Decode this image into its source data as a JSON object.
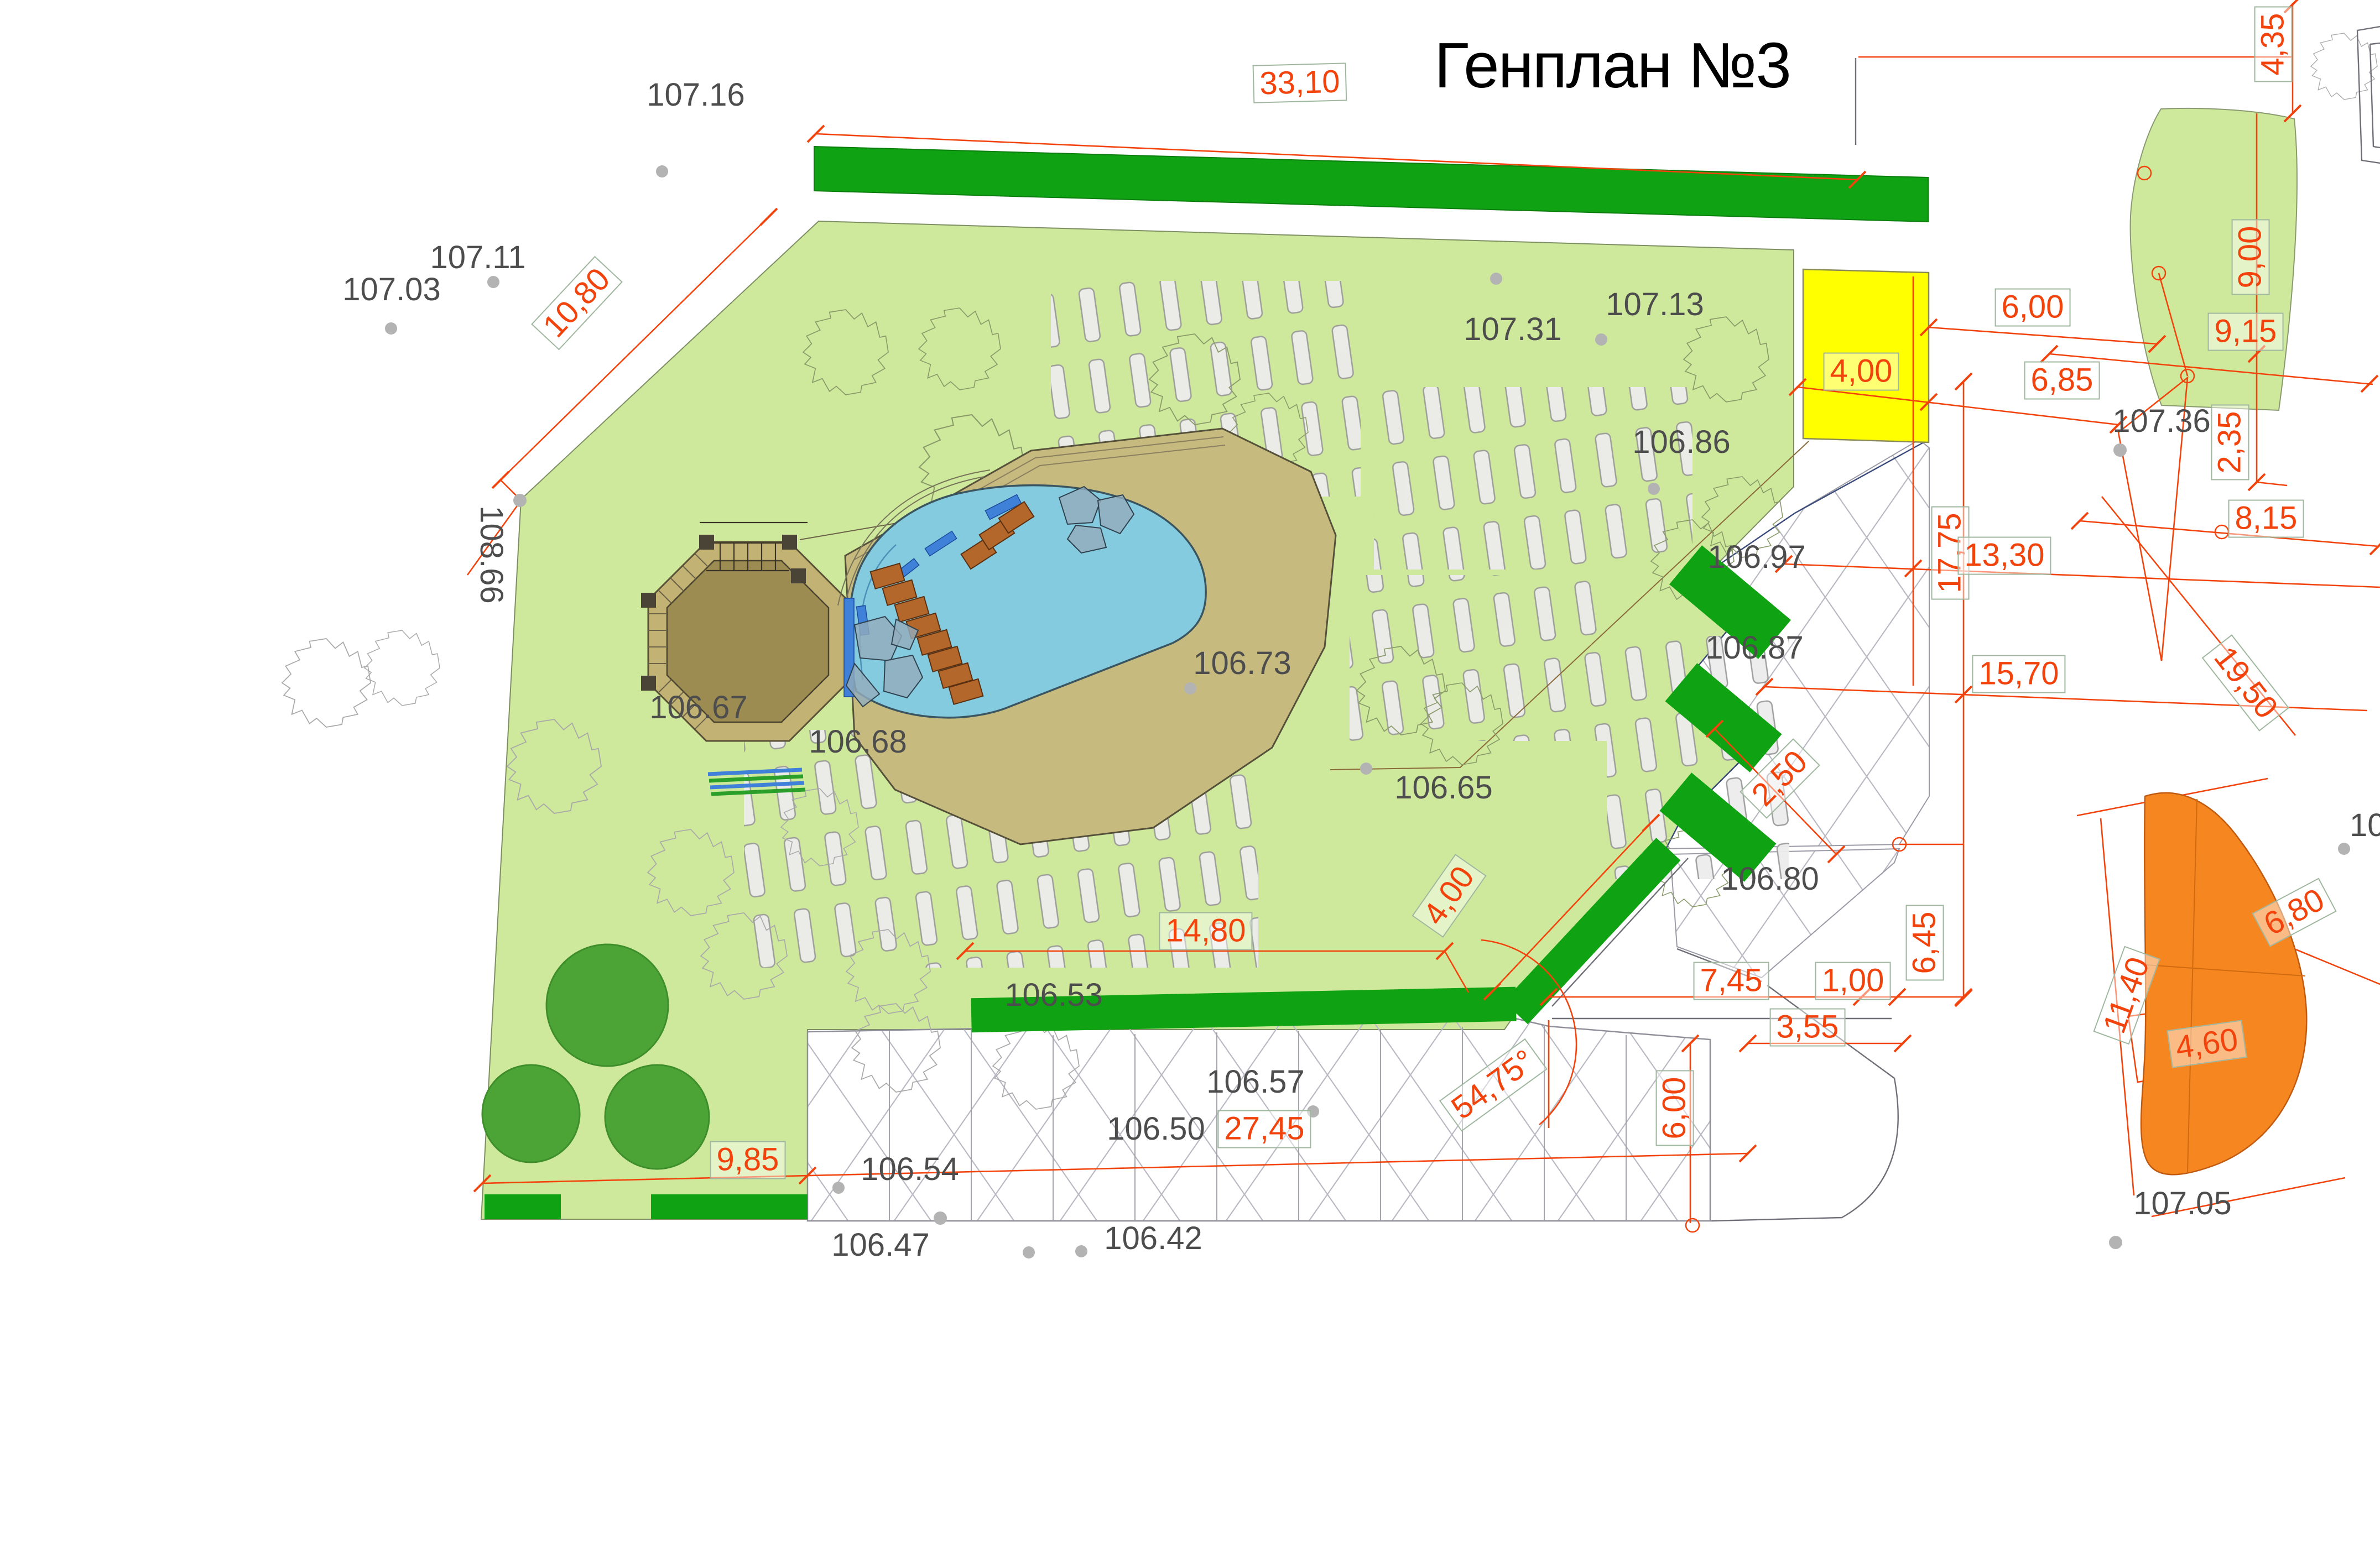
{
  "title": "Генплан №3",
  "elevations": {
    "e107_16": "107.16",
    "e107_11": "107.11",
    "e107_03": "107.03",
    "e108_66": "108.66",
    "e107_31": "107.31",
    "e107_13": "107.13",
    "e106_86": "106.86",
    "e106_97": "106.97",
    "e106_87": "106.87",
    "e106_73": "106.73",
    "e106_65": "106.65",
    "e106_80": "106.80",
    "e106_67": "106.67",
    "e106_68": "106.68",
    "e106_53": "106.53",
    "e106_57": "106.57",
    "e106_50": "106.50",
    "e106_54": "106.54",
    "e106_47": "106.47",
    "e106_42": "106.42",
    "e107_36": "107.36",
    "e107_05": "107.05",
    "e10_cut": "10"
  },
  "dimensions": {
    "d33_10": "33,10",
    "d10_80": "10,80",
    "d4_35": "4,35",
    "d6_00a": "6,00",
    "d4_00a": "4,00",
    "d6_85": "6,85",
    "d9_00": "9,00",
    "d9_15": "9,15",
    "d2_35": "2,35",
    "d8_15": "8,15",
    "d17_75": "17,75",
    "d13_30": "13,30",
    "d15_70": "15,70",
    "d19_50": "19,50",
    "d2_50": "2,50",
    "d4_00b": "4,00",
    "d14_80": "14,80",
    "d7_45": "7,45",
    "d1_00": "1,00",
    "d3_55": "3,55",
    "d6_45": "6,45",
    "d54_75": "54,75°",
    "d6_00b": "6,00",
    "d27_45": "27,45",
    "d9_85": "9,85",
    "d6_80": "6,80",
    "d11_40": "11,40",
    "d4_60": "4,60"
  },
  "colors": {
    "lawn": "#CEE99B",
    "hedge_green": "#0FA212",
    "tree_green": "#4CA437",
    "pool_blue": "#85CBDF",
    "deck_tan": "#C6BA7E",
    "octagon_brown": "#9C8C52",
    "steps_terracotta": "#B4672B",
    "accent_yellow": "#FFFF00",
    "blob_orange": "#F6861F",
    "dim_red": "#F3430D",
    "label_gray": "#4D4D4D"
  }
}
